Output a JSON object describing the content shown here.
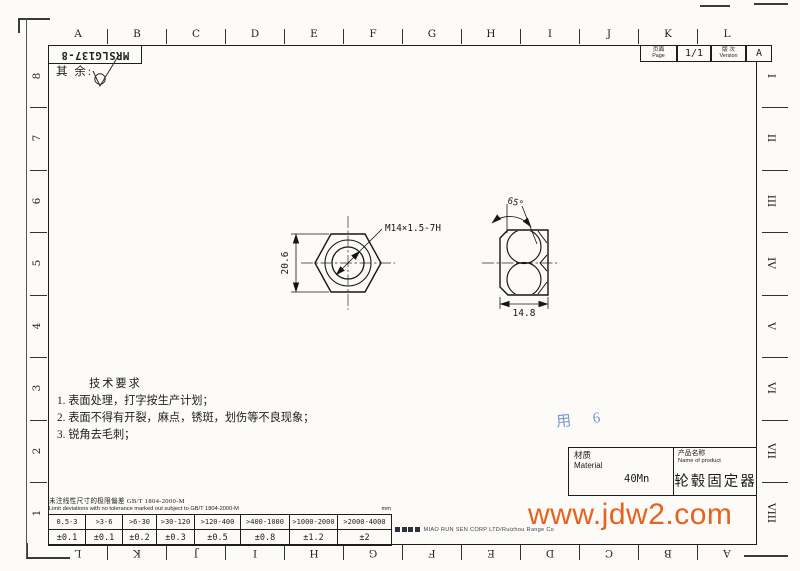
{
  "drawing": {
    "number": "MRSLG137-8",
    "surface_note_label": "其 余:",
    "page": {
      "label_cn": "页面",
      "label_en": "Page",
      "value": "1/1"
    },
    "version": {
      "label_cn": "版 次",
      "label_en": "Version",
      "value": "A"
    }
  },
  "views": {
    "front": {
      "thread_callout": "M14×1.5-7H",
      "across_flats": "20.6"
    },
    "side": {
      "chamfer_angle": "65°",
      "width": "14.8"
    }
  },
  "zones": {
    "top": [
      "A",
      "B",
      "C",
      "D",
      "E",
      "F",
      "G",
      "H",
      "I",
      "J",
      "K",
      "L"
    ],
    "bottom": [
      "L",
      "K",
      "J",
      "I",
      "H",
      "G",
      "F",
      "E",
      "D",
      "C",
      "B",
      "A"
    ],
    "left": [
      "8",
      "7",
      "6",
      "5",
      "4",
      "3",
      "2",
      "1"
    ],
    "right": [
      "I",
      "II",
      "III",
      "IV",
      "V",
      "VI",
      "VII",
      "VIII"
    ]
  },
  "tech_requirements": {
    "title": "技术要求",
    "items": [
      "1. 表面处理，打字按生产计划；",
      "2. 表面不得有开裂，麻点，锈斑，划伤等不良现象；",
      "3. 锐角去毛刺；"
    ]
  },
  "material_block": {
    "material_label_cn": "材质",
    "material_label_en": "Material",
    "material_value": "40Mn",
    "product_label_cn": "产品名称",
    "product_label_en": "Name of product",
    "product_value": "轮毂固定器"
  },
  "annotations": {
    "handwritten_note": "用 6"
  },
  "tolerance_table": {
    "title_cn": "未注线性尺寸的极限偏差 GB/T 1804-2000-M",
    "title_en": "Limit deviations with no tolerance marked out subject to GB/T 1804-2000-M",
    "unit": "mm",
    "ranges": [
      "0.5-3",
      ">3-6",
      ">6-30",
      ">30-120",
      ">120-400",
      ">400-1000",
      ">1000-2000",
      ">2000-4000"
    ],
    "values": [
      "±0.1",
      "±0.1",
      "±0.2",
      "±0.3",
      "±0.5",
      "±0.8",
      "±1.2",
      "±2"
    ]
  },
  "footer": {
    "company": "MIAO RUN SEN CORP LTD/Ruizhou Range Co"
  },
  "watermark": {
    "text": "www.jdw2.com",
    "color": "#e8611f"
  }
}
